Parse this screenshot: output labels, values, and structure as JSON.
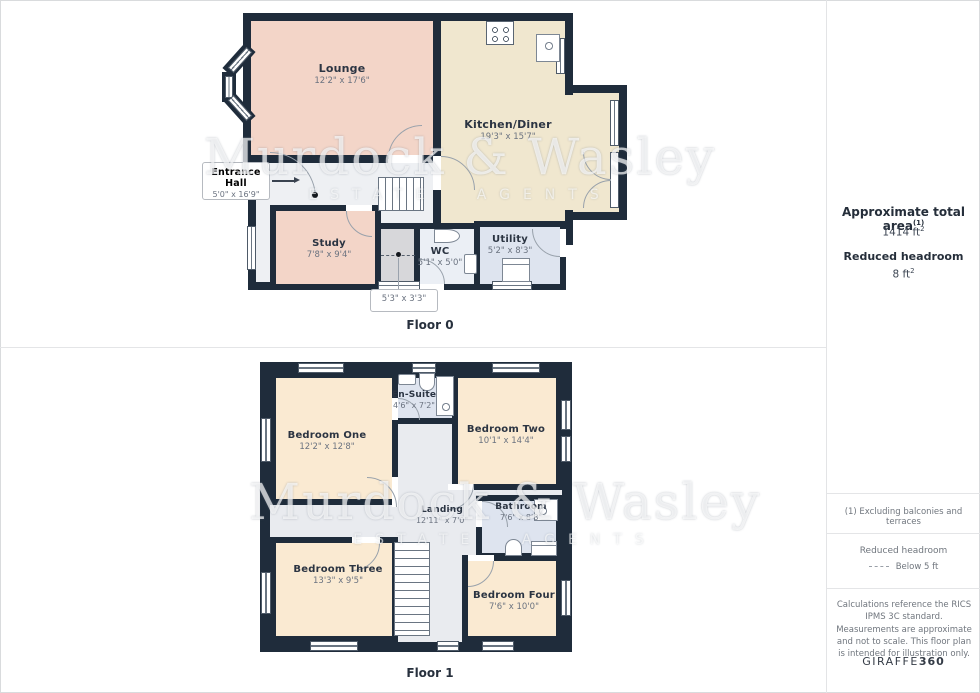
{
  "floors": [
    {
      "label": "Floor 0",
      "rooms": [
        {
          "name": "Lounge",
          "dims": "12'2\" x 17'6\""
        },
        {
          "name": "Kitchen/Diner",
          "dims": "19'3\" x 15'7\""
        },
        {
          "name": "Entrance Hall",
          "dims": "5'0\" x 16'9\""
        },
        {
          "name": "Study",
          "dims": "7'8\" x 9'4\""
        },
        {
          "name": "WC",
          "dims": "5'1\" x 5'0\""
        },
        {
          "name": "Utility",
          "dims": "5'2\" x 8'3\""
        },
        {
          "name": "",
          "dims": "5'3\" x 3'3\""
        }
      ]
    },
    {
      "label": "Floor 1",
      "rooms": [
        {
          "name": "Bedroom One",
          "dims": "12'2\" x 12'8\""
        },
        {
          "name": "En-Suite",
          "dims": "4'6\" x 7'2\""
        },
        {
          "name": "Bedroom Two",
          "dims": "10'1\" x 14'4\""
        },
        {
          "name": "Landing",
          "dims": "12'11\" x 7'0\""
        },
        {
          "name": "Bathroom",
          "dims": "7'6\" x 8'8\""
        },
        {
          "name": "Bedroom Three",
          "dims": "13'3\" x 9'5\""
        },
        {
          "name": "Bedroom Four",
          "dims": "7'6\" x 10'0\""
        }
      ]
    }
  ],
  "watermark": {
    "line1": "Murdock & Wasley",
    "line2": "ESTATE  AGENTS"
  },
  "sidebar": {
    "total_area_label": "Approximate total area",
    "total_area_sup": "(1)",
    "total_area_value": "1414 ft",
    "total_area_value_sup": "2",
    "headroom_label": "Reduced headroom",
    "headroom_value": "8 ft",
    "headroom_value_sup": "2",
    "footnote": "(1) Excluding balconies and terraces",
    "legend_title": "Reduced headroom",
    "legend_value": "Below 5 ft",
    "disclaimer": "Calculations reference the RICS IPMS 3C standard. Measurements are approximate and not to scale. This floor plan is intended for illustration only.",
    "brand_name": "GIRAFFE",
    "brand_suffix": "360"
  },
  "colors": {
    "wall": "#1f2c3b",
    "lounge_study": "#f3d5c8",
    "kitchen": "#f0e7cf",
    "bedroom": "#faead2",
    "wet_room": "#dee4ef",
    "wc": "#ebeff5",
    "hall": "#eef0f3",
    "landing": "#e9ebef",
    "cupboard": "#d7d7da"
  }
}
